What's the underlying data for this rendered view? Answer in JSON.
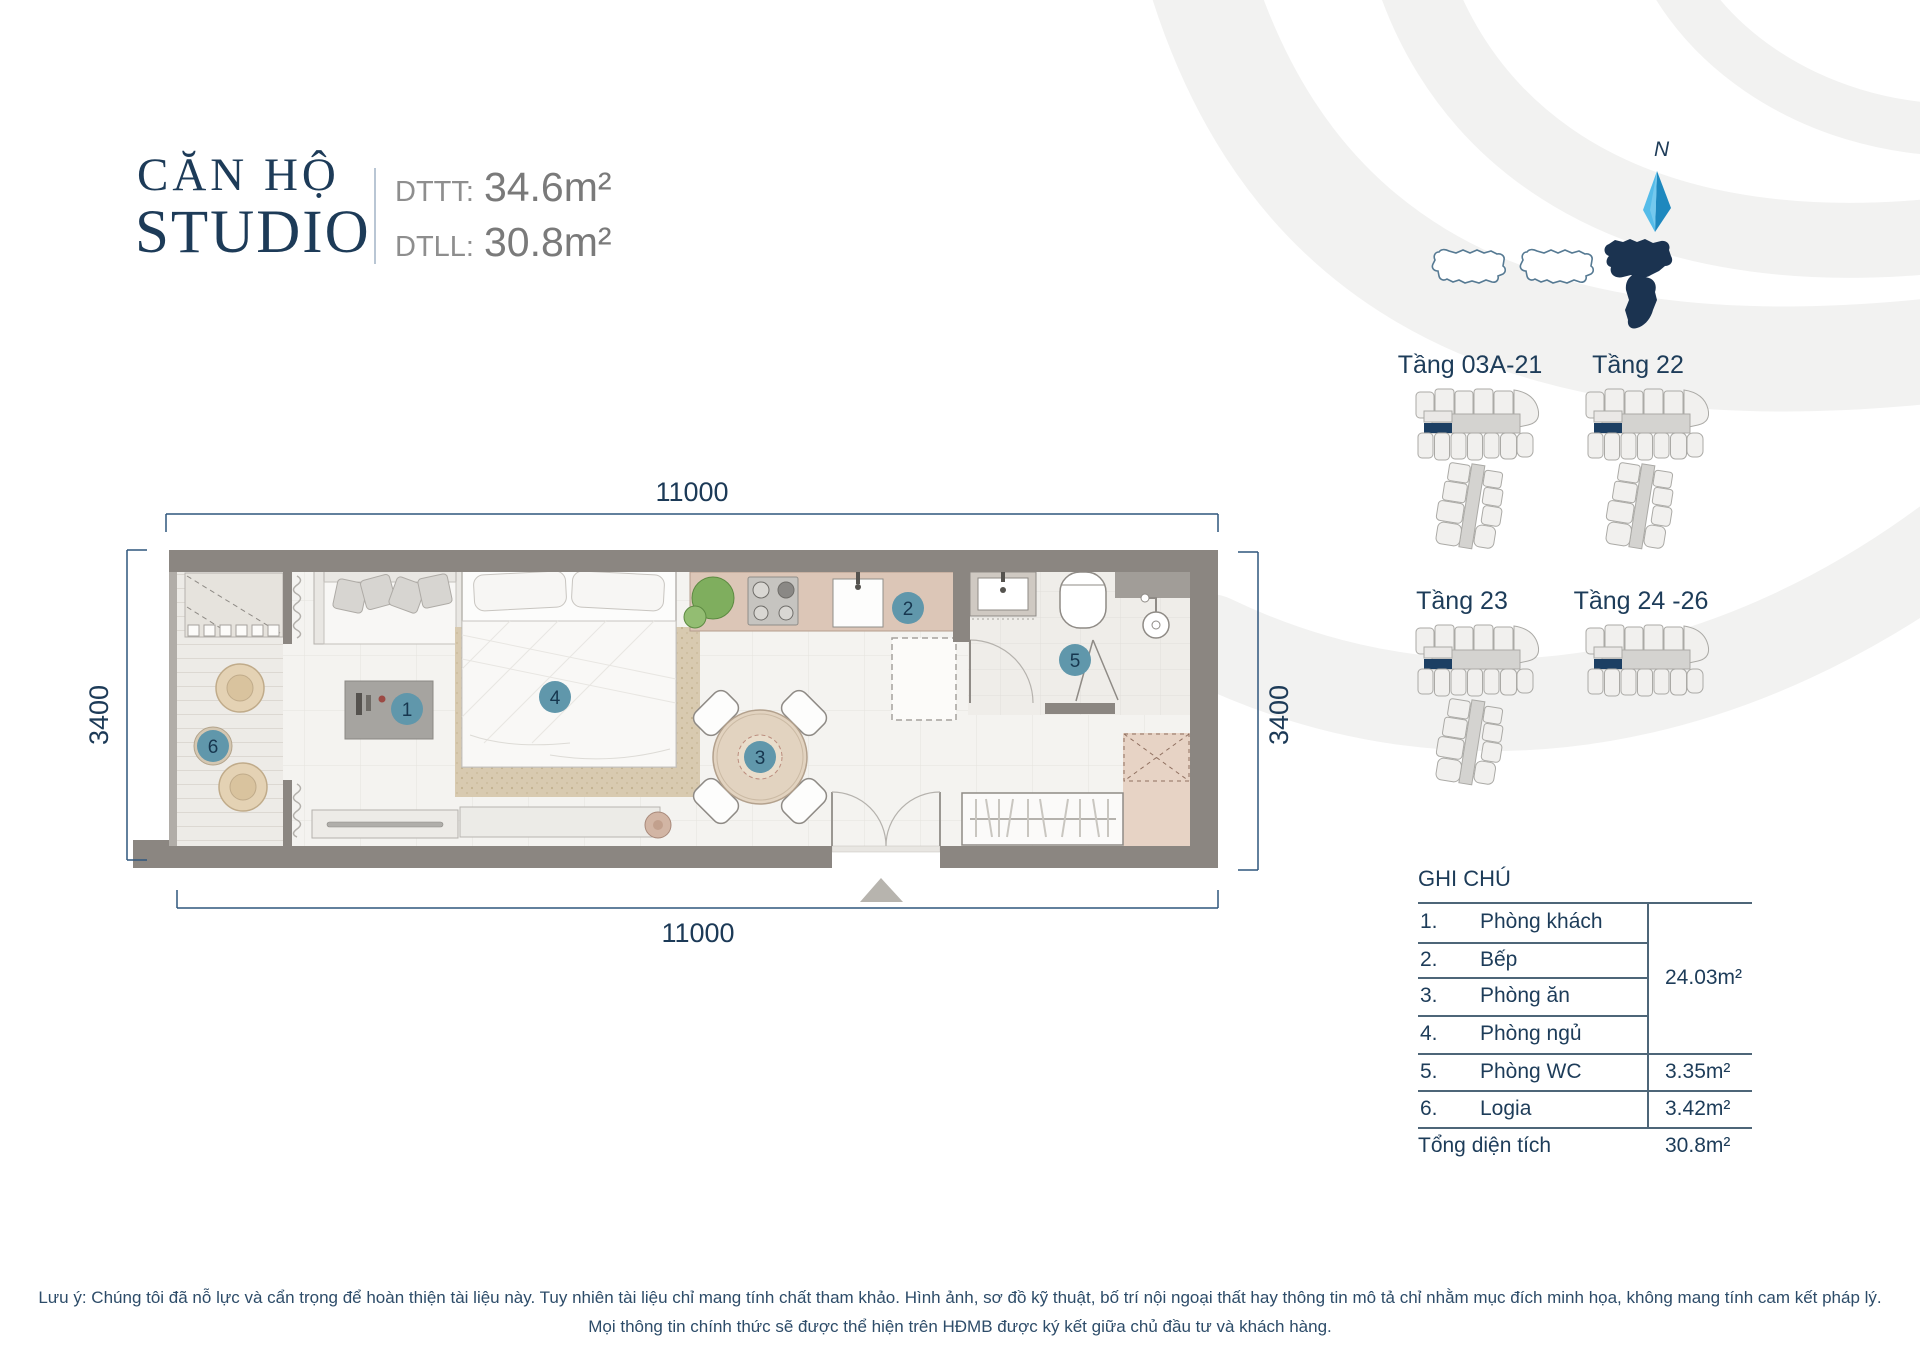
{
  "header": {
    "title_line1": "CĂN HỘ",
    "title_line2": "STUDIO",
    "dttt_label": "DTTT:",
    "dttt_value": "34.6m²",
    "dtll_label": "DTLL:",
    "dtll_value": "30.8m²"
  },
  "site_map": {
    "north_label": "N"
  },
  "floor_plates": [
    {
      "label": "Tầng 03A-21"
    },
    {
      "label": "Tầng 22"
    },
    {
      "label": "Tầng 23"
    },
    {
      "label": "Tầng 24 -26"
    }
  ],
  "floor_plan": {
    "dim_top": "11000",
    "dim_bottom": "11000",
    "dim_left": "3400",
    "dim_right": "3400",
    "markers": {
      "m1": "1",
      "m2": "2",
      "m3": "3",
      "m4": "4",
      "m5": "5",
      "m6": "6"
    }
  },
  "legend": {
    "title": "GHI CHÚ",
    "rows": [
      {
        "no": "1.",
        "name": "Phòng khách"
      },
      {
        "no": "2.",
        "name": "Bếp"
      },
      {
        "no": "3.",
        "name": "Phòng ăn"
      },
      {
        "no": "4.",
        "name": "Phòng ngủ"
      },
      {
        "no": "5.",
        "name": "Phòng WC",
        "area": "3.35m²"
      },
      {
        "no": "6.",
        "name": "Logia",
        "area": "3.42m²"
      }
    ],
    "group_area": "24.03m²",
    "total_label": "Tổng diện tích",
    "total_value": "30.8m²"
  },
  "disclaimer": {
    "line1": "Lưu ý: Chúng tôi đã nỗ lực và cẩn trọng để hoàn thiện tài liệu này. Tuy nhiên tài liệu chỉ mang tính chất tham khảo. Hình ảnh, sơ đồ kỹ thuật, bố trí nội ngoại thất hay thông tin mô tả chỉ nhằm mục đích minh họa, không mang tính cam kết pháp lý.",
    "line2": "Mọi thông tin chính thức sẽ được thể hiện trên HĐMB được ký kết giữa chủ đầu tư và khách hàng."
  },
  "colors": {
    "navy": "#1c3a57",
    "gray_text": "#8a8a8a",
    "marker_fill": "#6097ab",
    "wall_gray": "#8b8681",
    "unit_highlight": "#1c3f63",
    "north_blue_light": "#53bbe8",
    "north_blue_dark": "#1e88be",
    "wave_gray": "#f2f2f1"
  }
}
